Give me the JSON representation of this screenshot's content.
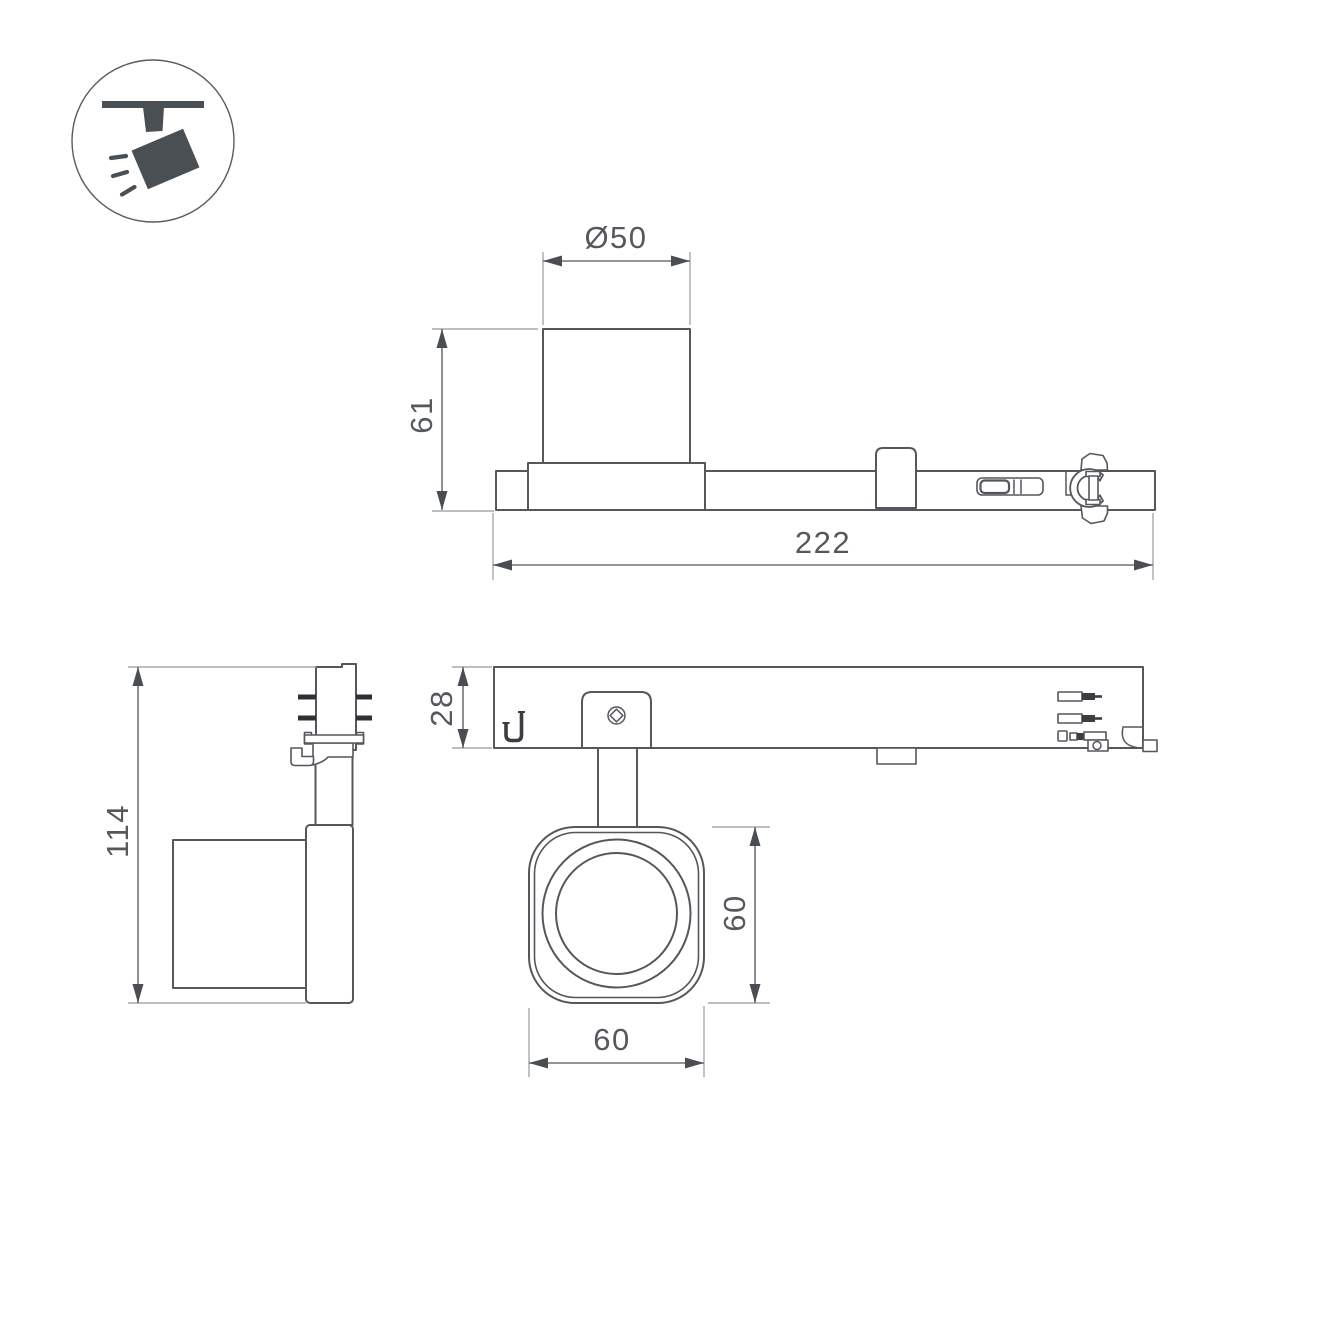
{
  "meta": {
    "type": "technical-dimension-drawing",
    "subject": "track-mounted LED spotlight with adapter"
  },
  "icon": {
    "label": "track-spotlight"
  },
  "colors": {
    "object_line": "#54575b",
    "dimension_line": "#6e7276",
    "extension_line": "#a6aaae",
    "text": "#55585c",
    "icon_fill": "#4a4f54",
    "background": "#ffffff"
  },
  "dimensions": {
    "head_diameter": "Ø50",
    "head_height": "61",
    "total_length": "222",
    "track_body_height": "28",
    "overall_height": "114",
    "lamp_face_height": "60",
    "lamp_face_width": "60"
  }
}
